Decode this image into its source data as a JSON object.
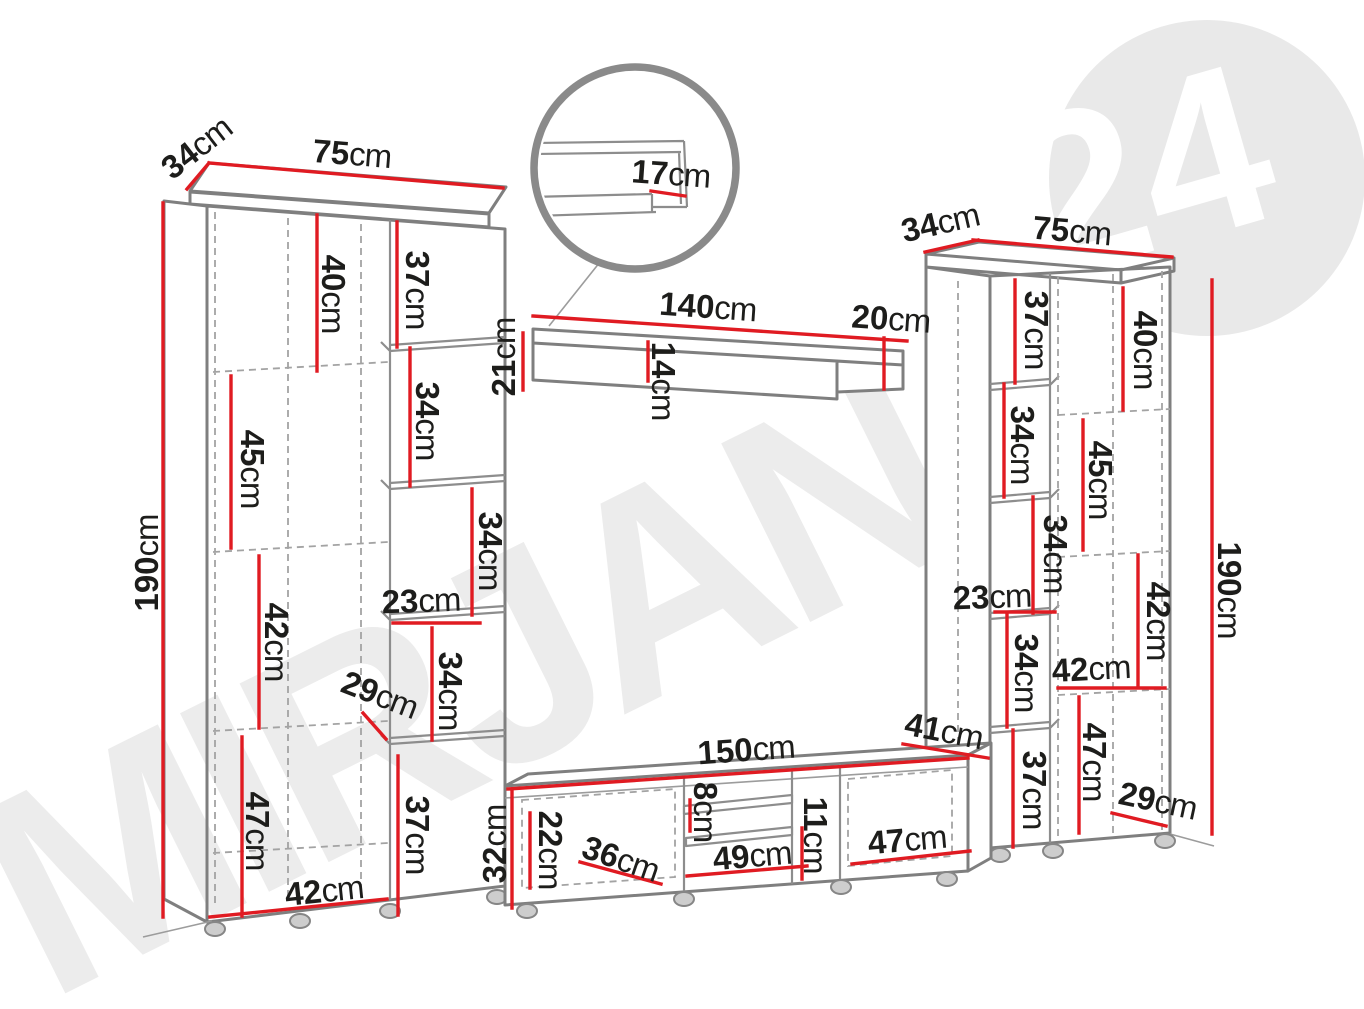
{
  "unit": "cm",
  "watermark": {
    "text": "MIRJAN",
    "badge": "24"
  },
  "colors": {
    "dimension_red": "#e01b22",
    "outline_gray": "#7f7f7f",
    "label_dark": "#1d1d1b",
    "watermark_gray": "#ececec"
  },
  "dims": {
    "left": {
      "depth": "34",
      "width": "75",
      "height": "190",
      "s40": "40",
      "s45": "45",
      "s42": "42",
      "s47": "47",
      "bottom": "42",
      "c37a": "37",
      "c34a": "34",
      "c34b": "34",
      "c23": "23",
      "c34c": "34",
      "c29": "29",
      "c37b": "37"
    },
    "shelf": {
      "width": "140",
      "right": "20",
      "height": "21",
      "inner": "14",
      "detail": "17"
    },
    "tv": {
      "width": "150",
      "depth": "41",
      "left": "22",
      "door": "36",
      "gap8": "8",
      "middle": "49",
      "gap11": "11",
      "right": "47",
      "height": "32"
    },
    "right": {
      "depth": "34",
      "width": "75",
      "height": "190",
      "c37a": "37",
      "c34a": "34",
      "c34b": "34",
      "c23": "23",
      "c34c": "34",
      "c37b": "37",
      "s40": "40",
      "s45": "45",
      "s42v": "42",
      "s42h": "42",
      "s47": "47",
      "s29": "29"
    }
  }
}
